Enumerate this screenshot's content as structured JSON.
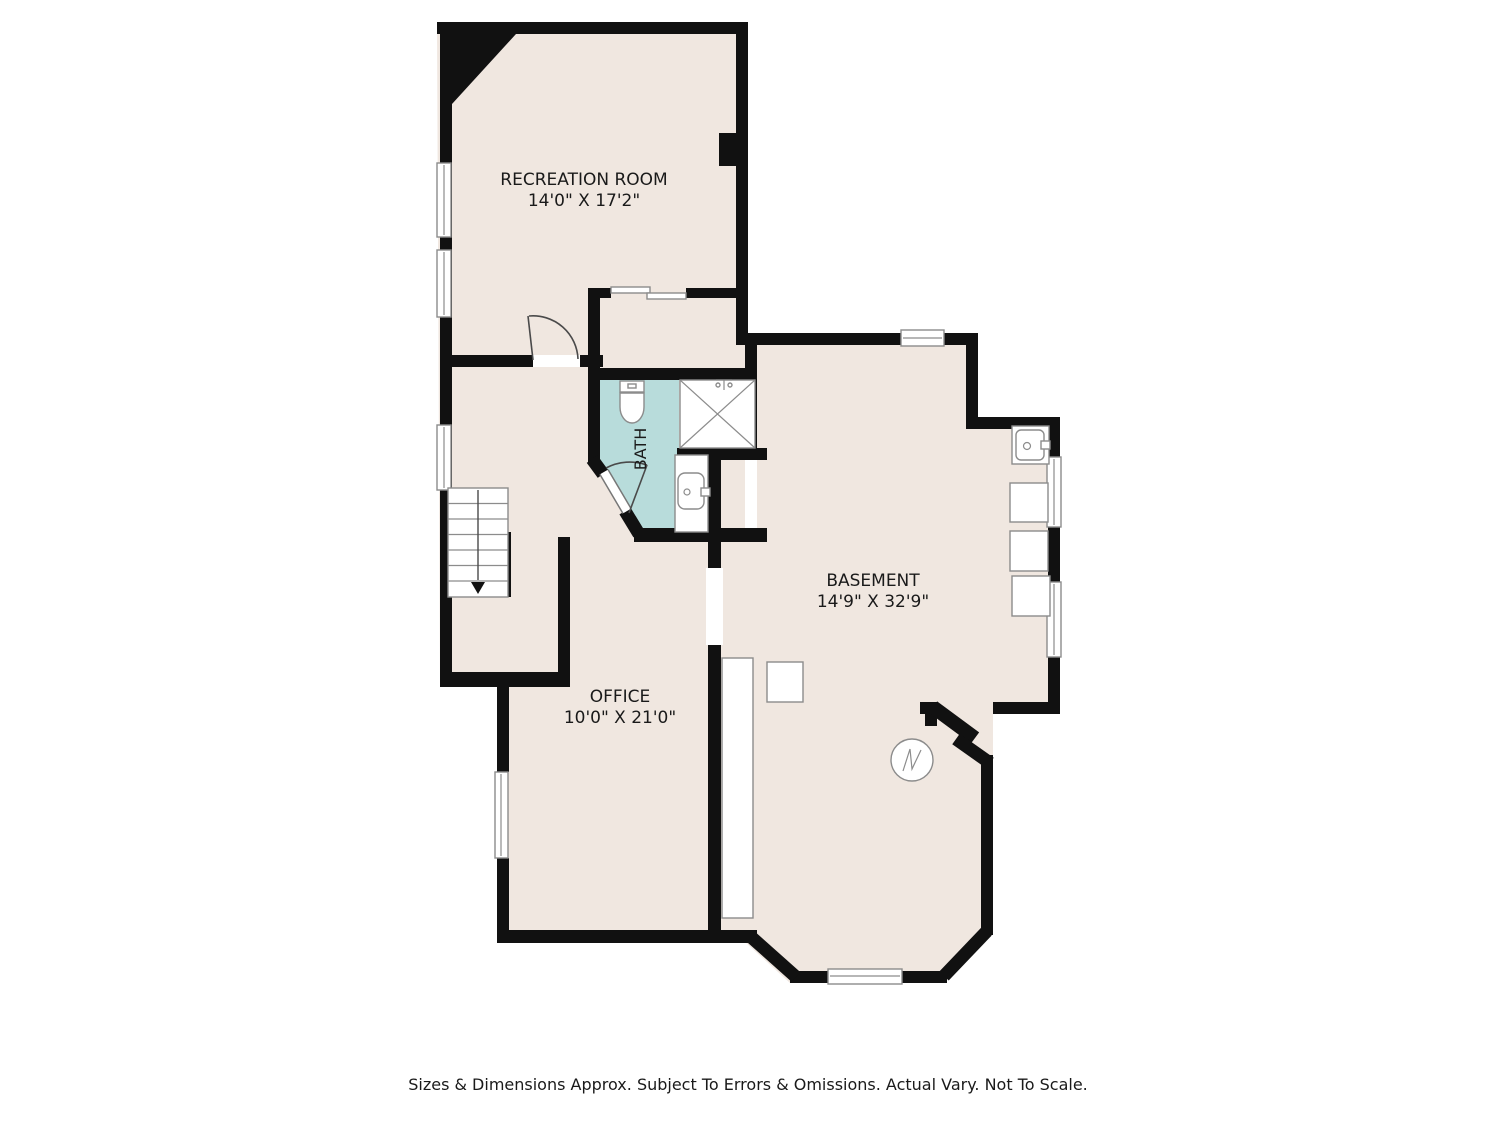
{
  "rooms": {
    "recreation": {
      "name": "RECREATION ROOM",
      "dims": "14'0\" X 17'2\""
    },
    "bath": {
      "name": "BATH"
    },
    "basement": {
      "name": "BASEMENT",
      "dims": "14'9\" X 32'9\""
    },
    "office": {
      "name": "OFFICE",
      "dims": "10'0\" X 21'0\""
    }
  },
  "footer": {
    "disclaimer": "Sizes & Dimensions Approx. Subject To Errors & Omissions. Actual Vary. Not To Scale."
  },
  "fixtures": {
    "bath": [
      "toilet-icon",
      "shower-icon",
      "sink-vanity-icon"
    ],
    "basement": [
      "laundry-tub-icon",
      "washer-icon",
      "dryer-icon",
      "appliance-icon",
      "furnace-icon",
      "sump-pump-icon",
      "storage-chase"
    ],
    "hall": [
      "staircase-down"
    ]
  },
  "colors": {
    "wall": "#111111",
    "floor": "#F0E7E0",
    "bath_floor": "#B8DCDB",
    "fixture_line": "#8C8C8C",
    "text": "#1A1A1A",
    "background": "#FFFFFF"
  }
}
